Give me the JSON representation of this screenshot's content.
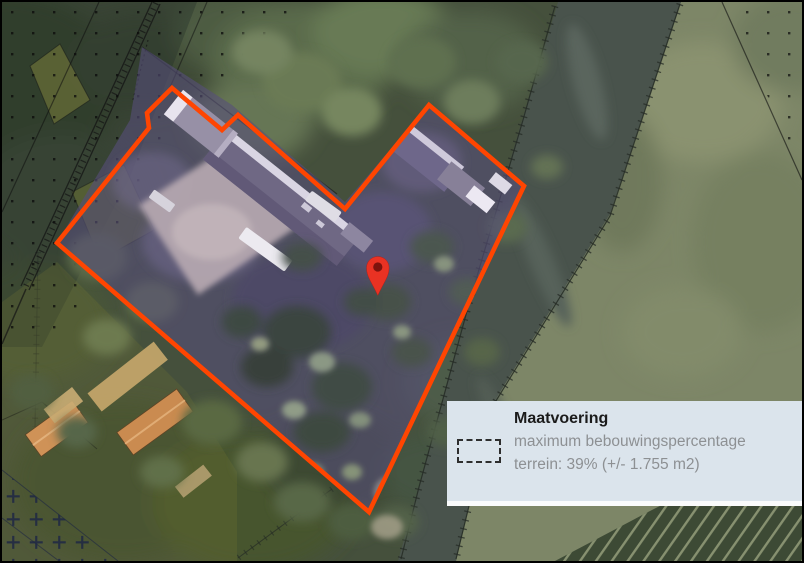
{
  "legend": {
    "title": "Maatvoering",
    "lines": [
      "maximum bebouwingspercentage",
      "terrein: 39% (+/- 1.755 m2)"
    ],
    "symbol": "dashed-rectangle-icon"
  },
  "marker": {
    "name": "location-pin"
  },
  "colors": {
    "parcel_outline": "#ff4501",
    "parcel_fill": "#574f79",
    "pin": "#e93223",
    "pin_center": "#7d130d",
    "panel_bg": "#dbe4ec",
    "panel_title": "#1b1b1b",
    "panel_text": "#8d9093",
    "water": "#49534c",
    "field": "#7d8667"
  }
}
